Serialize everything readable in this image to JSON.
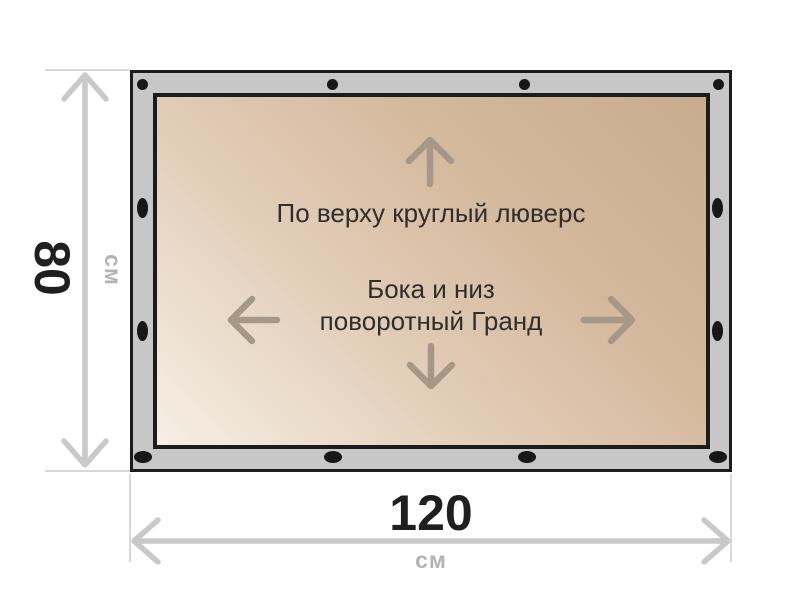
{
  "diagram": {
    "banner_labels": {
      "top": "По верху круглый люверс",
      "center_line1": "Бока и низ",
      "center_line2": "поворотный Гранд"
    },
    "height_dimension": {
      "value": "80",
      "unit": "см"
    },
    "width_dimension": {
      "value": "120",
      "unit": "см"
    },
    "colors": {
      "frame_fill": "#c7c7c7",
      "frame_border": "#1c1c1c",
      "canvas_light": "#f6efe5",
      "canvas_dark": "#c9ac8f",
      "grommet": "#171717",
      "direction_arrow": "#a59889",
      "dimension_line": "#c9c9c9",
      "extension_line": "#d8d8d8",
      "dimension_value_text": "#1f1f1f",
      "dimension_unit_text": "#b3b3b3",
      "label_text": "#2e2e2e"
    }
  }
}
